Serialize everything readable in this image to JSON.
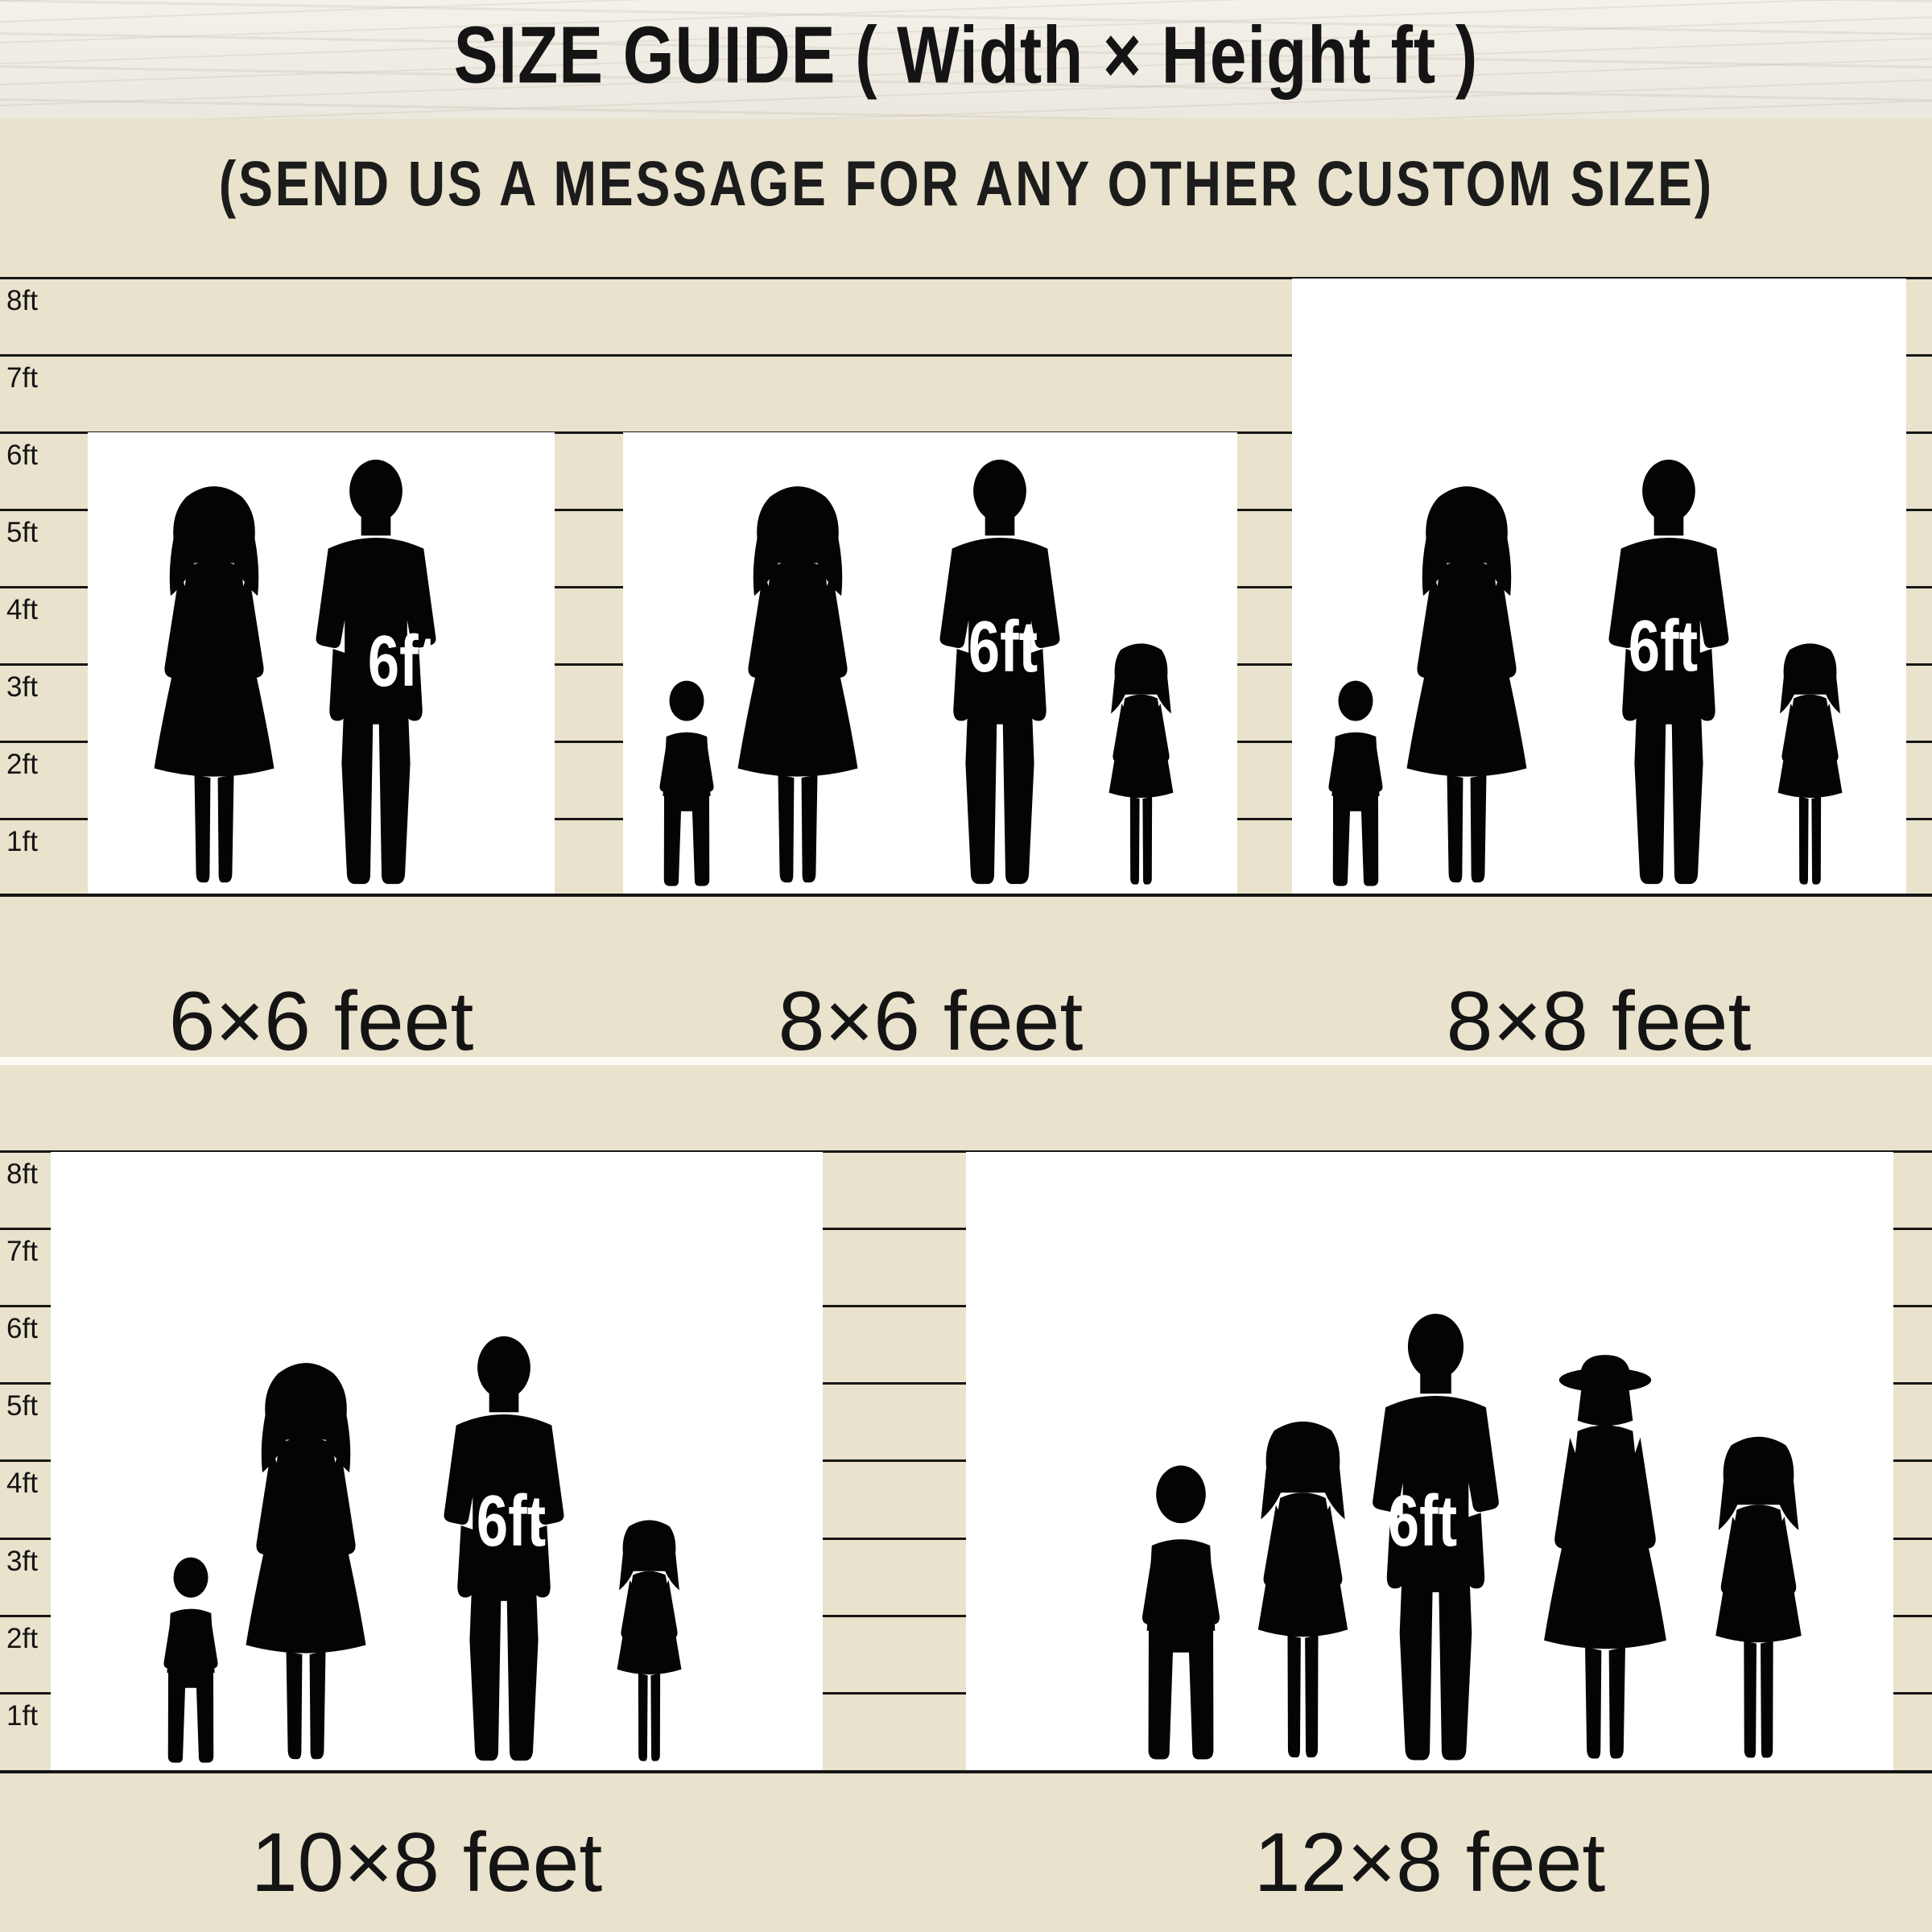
{
  "header": {
    "title": "SIZE GUIDE ( Width × Height ft )"
  },
  "subtitle": "(SEND US A MESSAGE FOR ANY OTHER CUSTOM SIZE)",
  "colors": {
    "background_beige": "#e9e2cc",
    "wood_header": "#f4f1ea",
    "ruler_line": "#161616",
    "box_white": "#ffffff",
    "silhouette_black": "#040404",
    "text_black": "#141414",
    "marker_white": "#ffffff"
  },
  "rulers": {
    "top": [
      "8ft",
      "7ft",
      "6ft",
      "5ft",
      "4ft",
      "3ft",
      "2ft",
      "1ft"
    ],
    "bottom": [
      "8ft",
      "7ft",
      "6ft",
      "5ft",
      "4ft",
      "3ft",
      "2ft",
      "1ft"
    ]
  },
  "sizes": [
    {
      "label": "6×6 feet",
      "width_ft": 6,
      "height_ft": 6,
      "person_marker": "6ft",
      "people": "couple"
    },
    {
      "label": "8×6 feet",
      "width_ft": 8,
      "height_ft": 6,
      "person_marker": "6ft",
      "people": "family-of-four"
    },
    {
      "label": "8×8 feet",
      "width_ft": 8,
      "height_ft": 8,
      "person_marker": "6ft",
      "people": "family-of-four"
    },
    {
      "label": "10×8 feet",
      "width_ft": 10,
      "height_ft": 8,
      "person_marker": "6ft",
      "people": "family-of-four"
    },
    {
      "label": "12×8 feet",
      "width_ft": 12,
      "height_ft": 8,
      "person_marker": "6ft",
      "people": "family-of-five"
    }
  ]
}
